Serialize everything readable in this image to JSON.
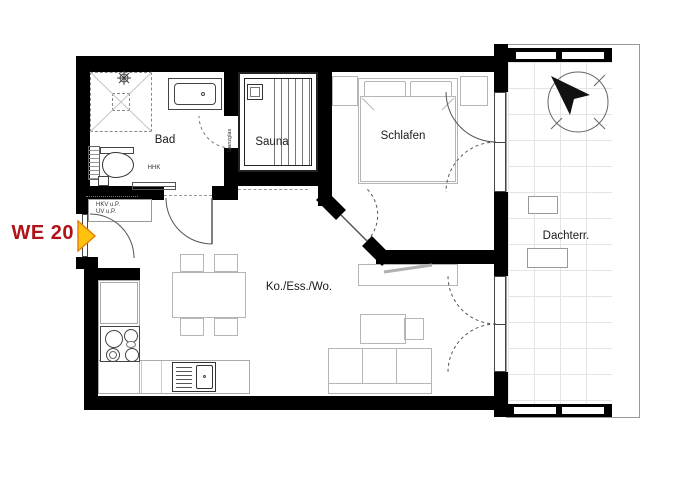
{
  "title": "Wohnung WE 20 Grundriss",
  "unit": {
    "label": "WE 20",
    "text_color": "#b01217",
    "arrow_fill": "#ffc20e",
    "arrow_stroke": "#e8820c"
  },
  "rooms": {
    "bad": {
      "label": "Bad"
    },
    "sauna": {
      "label": "Sauna"
    },
    "schlafen": {
      "label": "Schlafen"
    },
    "wohnen": {
      "label": "Ko./Ess./Wo."
    },
    "terrasse": {
      "label": "Dachterr."
    }
  },
  "annotations": {
    "towel_radiator": "HHK",
    "heating_circuit": "HKV u.P.",
    "sub_distribution": "UV u.P.",
    "sauna_door": "Ganzglas"
  },
  "colors": {
    "wall": "#000000",
    "furniture_line": "#b5b5b5",
    "fixture_line": "#444444",
    "tile_line": "#e4e4e4"
  }
}
